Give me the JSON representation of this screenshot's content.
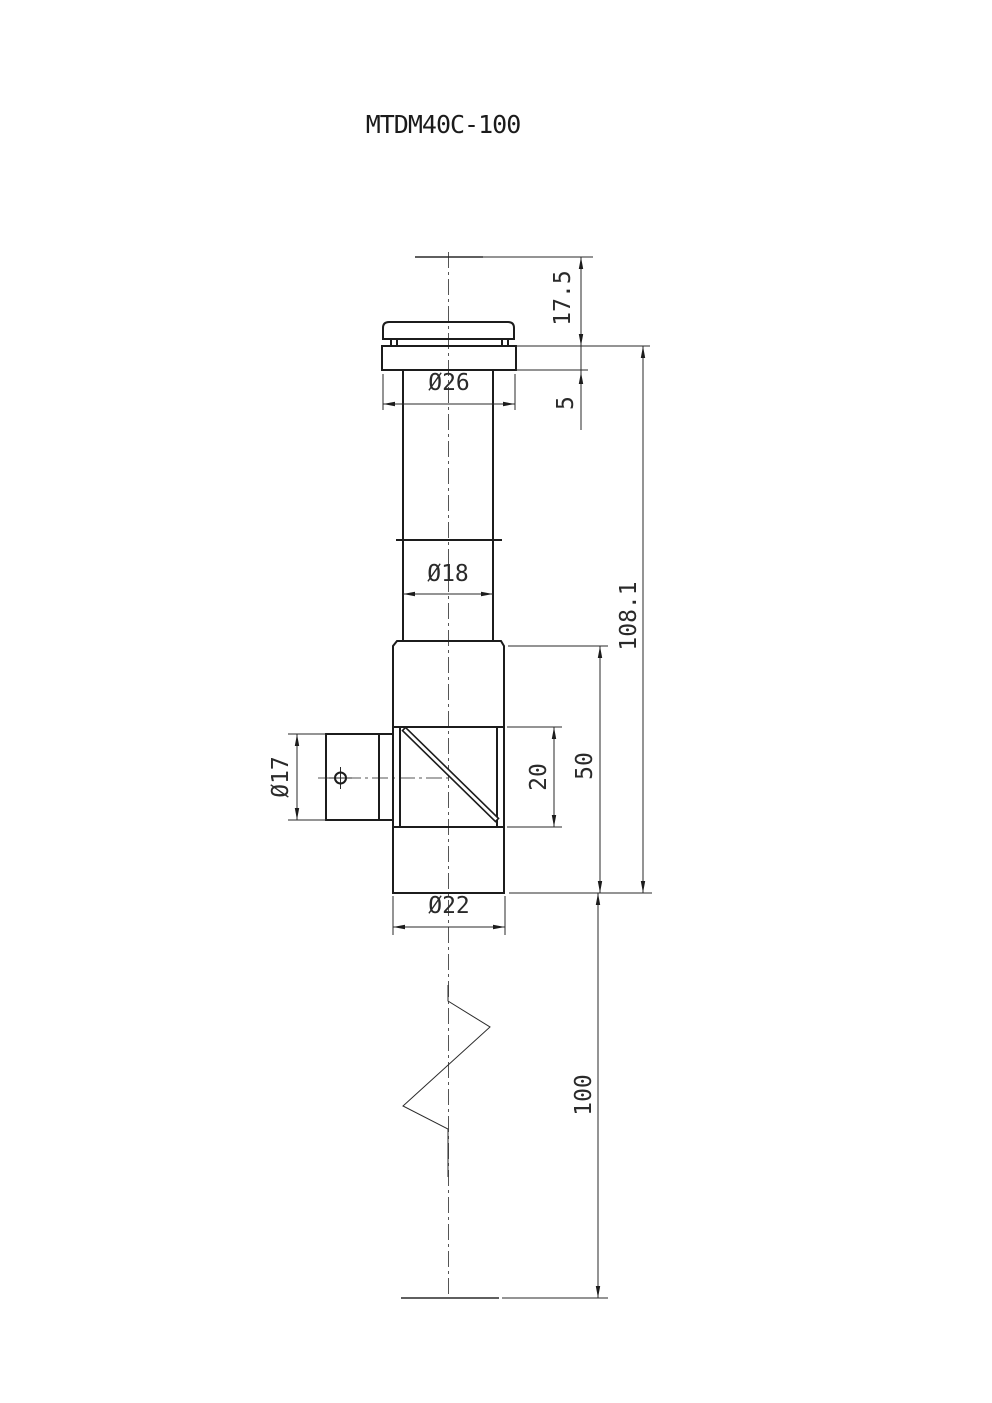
{
  "title": "MTDM40C-100",
  "colors": {
    "background": "#ffffff",
    "outline": "#1c1c1c",
    "thin_lines": "#2a2a2a",
    "centerline": "#555555"
  },
  "dimensions": {
    "top_offset": "17.5",
    "flange_thickness": "5",
    "flange_diameter": "Ø26",
    "tube_diameter": "Ø18",
    "overall_height": "108.1",
    "body_height": "50",
    "window_height": "20",
    "port_diameter": "Ø17",
    "body_diameter": "Ø22",
    "extension_length": "100"
  }
}
